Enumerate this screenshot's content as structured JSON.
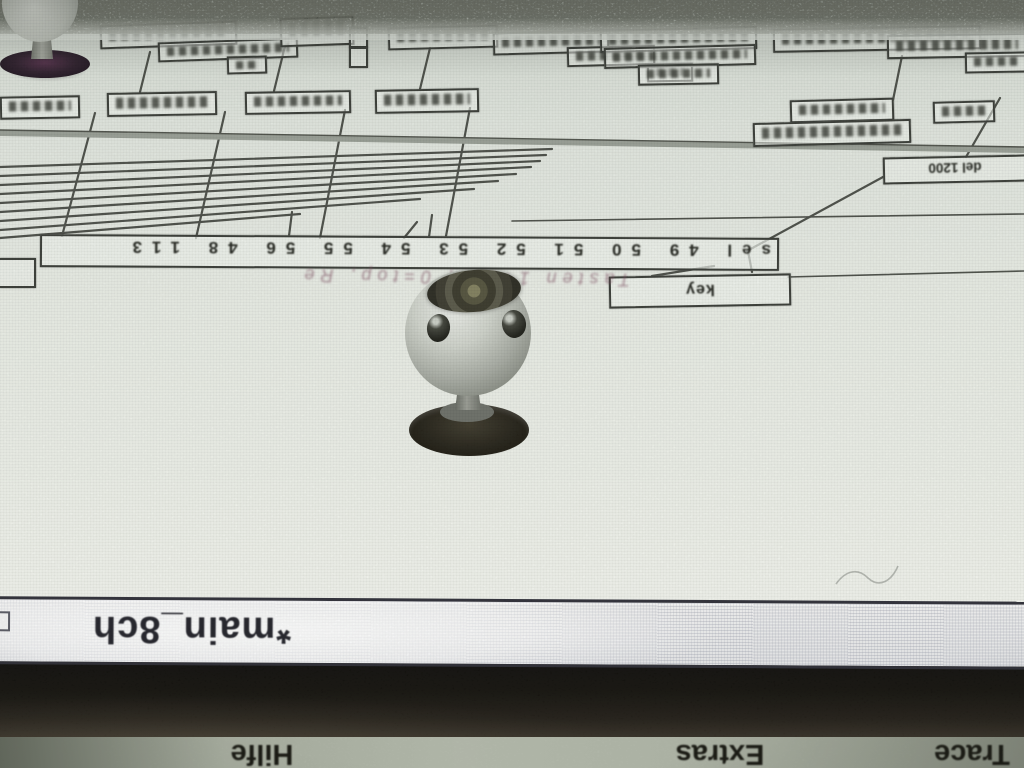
{
  "window": {
    "title": "*main_8ch"
  },
  "menu_bar": {
    "items": [
      {
        "label": "Trace"
      },
      {
        "label": "Extras"
      },
      {
        "label": "Hilfe"
      }
    ]
  },
  "patcher": {
    "objects": {
      "key": "key",
      "select": "sel 49 50 51 52 53 54 55 56 48 113",
      "delay": "del 1200"
    },
    "comment": "Tasten 1+2-9, 0=top, Re"
  },
  "colors": {
    "canvas": "#e9ede6",
    "patch_cord": "#3d403a",
    "title_bar": "#ededef",
    "bezel_band": "#14120e",
    "menu_strip": "#b2b8aa"
  }
}
